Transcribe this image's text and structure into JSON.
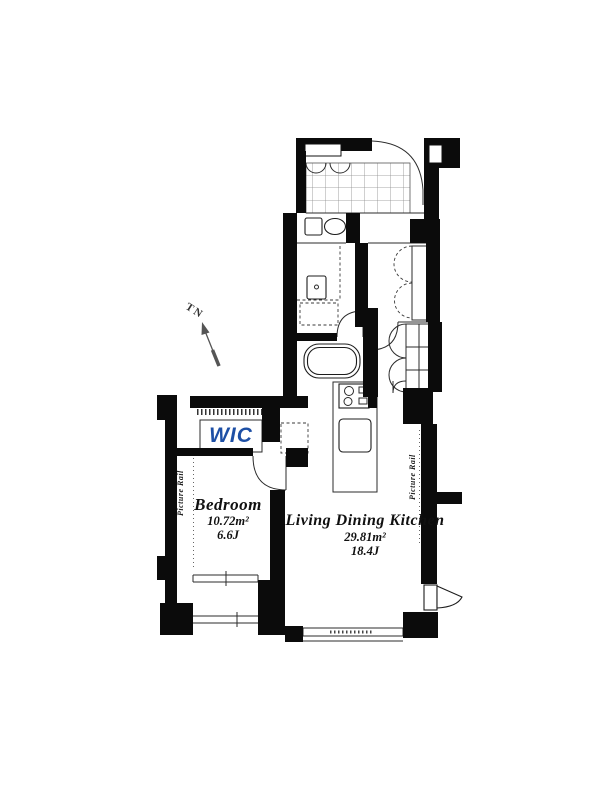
{
  "rooms": {
    "bedroom": {
      "name": "Bedroom",
      "area_sqm": "10.72m²",
      "area_tatami": "6.6J"
    },
    "ldk": {
      "name": "Living Dining Kitchen",
      "area_sqm": "29.81m²",
      "area_tatami": "18.4J"
    },
    "wic": {
      "label": "WIC"
    }
  },
  "annotations": {
    "picture_rail_left": "Picture Rail",
    "picture_rail_right": "Picture Rail",
    "compass_label": "TN"
  },
  "icons": {
    "entrance_door": "quarter-arc-door",
    "bedroom_door": "quarter-arc-door",
    "bathroom_door": "quarter-arc-door",
    "hallway_door": "quarter-arc-door",
    "balcony_door": "wedge-door",
    "closet_doors": "folding-arc",
    "toilet": "tank-and-bowl",
    "bathtub": "rounded-tub",
    "stove": "two-burners",
    "sink": "rounded-basin",
    "compass": "north-arrow"
  },
  "colors": {
    "wall": "#0b0b0b",
    "wic_text": "#1d4fa5",
    "line": "#2b2b2b"
  }
}
